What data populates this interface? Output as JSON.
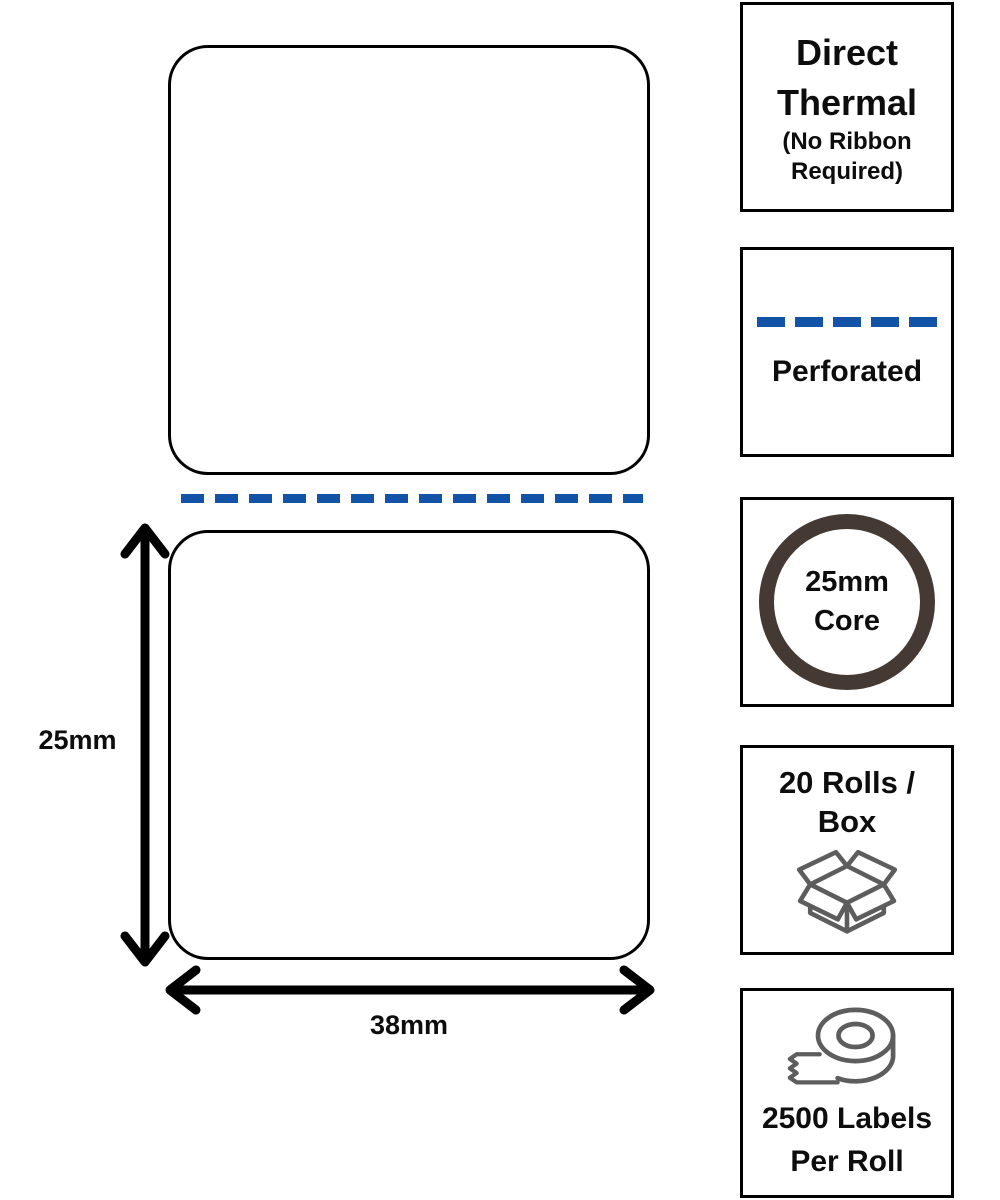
{
  "diagram": {
    "height_label": "25mm",
    "width_label": "38mm",
    "labels_shown": 2,
    "perforation_style": "blue dashed line between labels"
  },
  "features": [
    {
      "name": "direct-thermal",
      "title_line1": "Direct",
      "title_line2": "Thermal",
      "sub_line1": "(No Ribbon",
      "sub_line2": "Required)"
    },
    {
      "name": "perforated",
      "icon": "dashed-line-icon",
      "label": "Perforated"
    },
    {
      "name": "core-size",
      "icon": "circle-ring-icon",
      "line1": "25mm",
      "line2": "Core"
    },
    {
      "name": "rolls-per-box",
      "icon": "open-box-icon",
      "line1": "20 Rolls /",
      "line2": "Box"
    },
    {
      "name": "labels-per-roll",
      "icon": "tape-roll-icon",
      "line1": "2500 Labels",
      "line2": "Per Roll"
    }
  ],
  "colors": {
    "perforation_blue": "#1253a8",
    "core_ring_brown": "#443a33",
    "icon_gray": "#5d5d5d",
    "outline_black": "#000000",
    "text_black": "#0d0d0d",
    "background": "#ffffff"
  }
}
